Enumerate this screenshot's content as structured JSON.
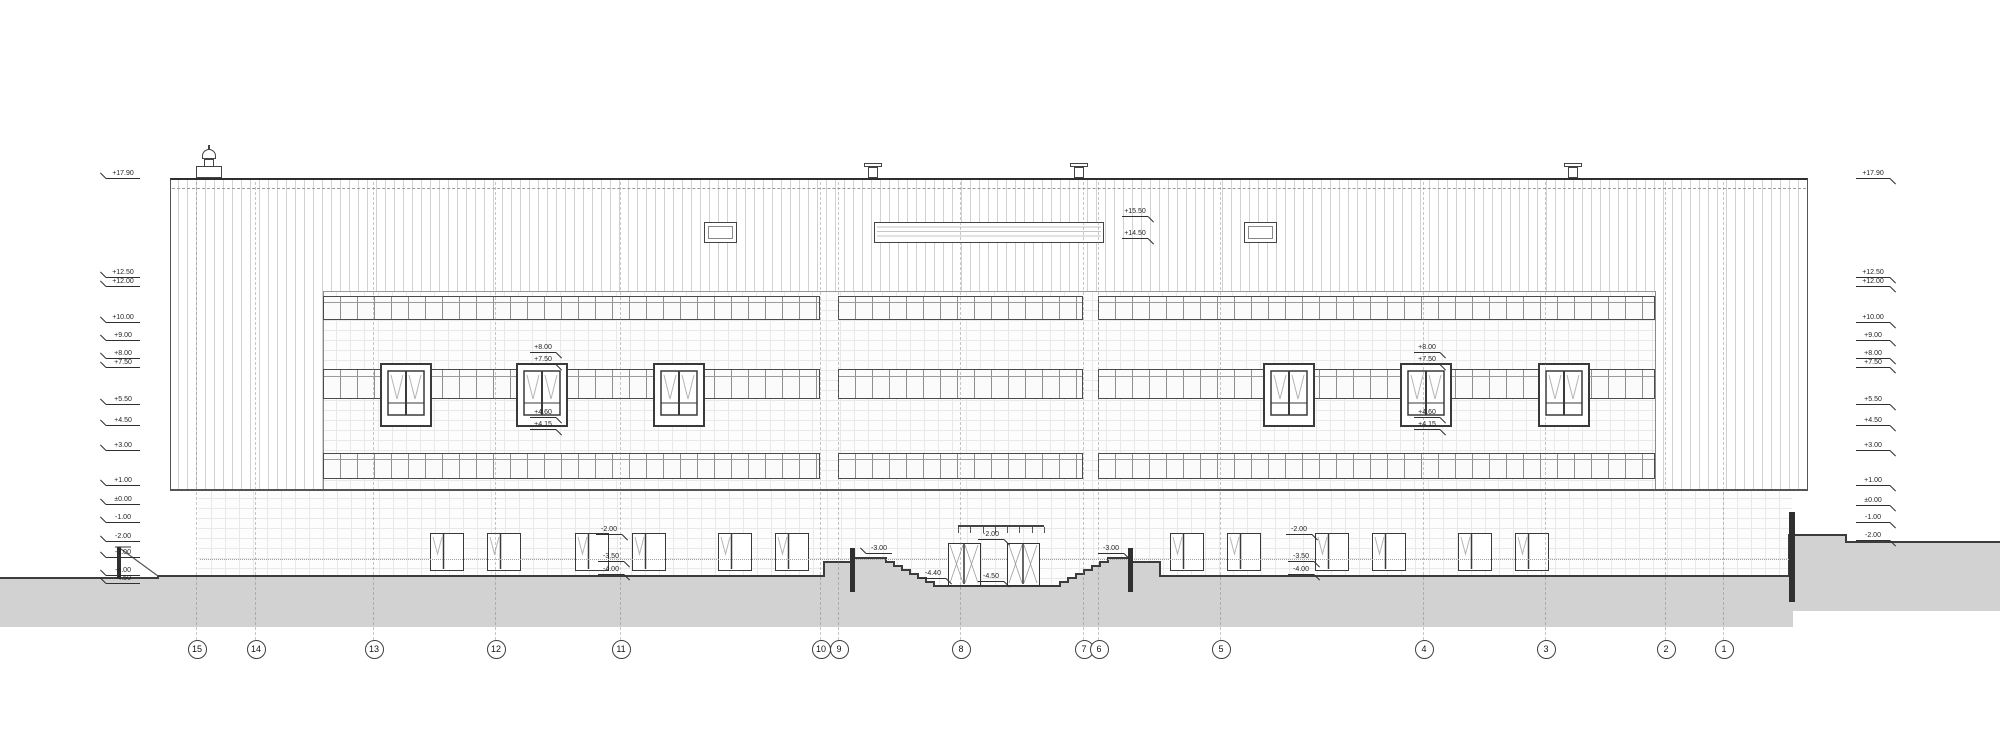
{
  "drawing": {
    "type": "architectural-elevation",
    "colors": {
      "line": "#2f2f2f",
      "mid": "#555555",
      "light": "#9a9a9a",
      "stripe": "#d2d2d2",
      "tile": "#e9e9e9",
      "ground": "#d2d2d2",
      "paper": "#ffffff"
    },
    "levels_left": [
      {
        "label": "+17.90",
        "y": 178
      },
      {
        "label": "+12.50",
        "y": 277
      },
      {
        "label": "+12.00",
        "y": 286
      },
      {
        "label": "+10.00",
        "y": 322
      },
      {
        "label": "+9.00",
        "y": 340
      },
      {
        "label": "+8.00",
        "y": 358
      },
      {
        "label": "+7.50",
        "y": 367
      },
      {
        "label": "+5.50",
        "y": 404
      },
      {
        "label": "+4.50",
        "y": 425
      },
      {
        "label": "+3.00",
        "y": 450
      },
      {
        "label": "+1.00",
        "y": 485
      },
      {
        "label": "±0.00",
        "y": 504
      },
      {
        "label": "-1.00",
        "y": 522
      },
      {
        "label": "-2.00",
        "y": 541
      },
      {
        "label": "-3.00",
        "y": 557
      },
      {
        "label": "-4.00",
        "y": 575
      },
      {
        "label": "-4.50",
        "y": 583
      }
    ],
    "levels_right": [
      {
        "label": "+17.90",
        "y": 178
      },
      {
        "label": "+12.50",
        "y": 277
      },
      {
        "label": "+12.00",
        "y": 286
      },
      {
        "label": "+10.00",
        "y": 322
      },
      {
        "label": "+9.00",
        "y": 340
      },
      {
        "label": "+8.00",
        "y": 358
      },
      {
        "label": "+7.50",
        "y": 367
      },
      {
        "label": "+5.50",
        "y": 404
      },
      {
        "label": "+4.50",
        "y": 425
      },
      {
        "label": "+3.00",
        "y": 450
      },
      {
        "label": "+1.00",
        "y": 485
      },
      {
        "label": "±0.00",
        "y": 505
      },
      {
        "label": "-1.00",
        "y": 522
      },
      {
        "label": "-2.00",
        "y": 540
      }
    ],
    "grid_axes": [
      {
        "label": "15",
        "x": 196
      },
      {
        "label": "14",
        "x": 255
      },
      {
        "label": "13",
        "x": 373
      },
      {
        "label": "12",
        "x": 495
      },
      {
        "label": "11",
        "x": 620
      },
      {
        "label": "10",
        "x": 820
      },
      {
        "label": "9",
        "x": 838
      },
      {
        "label": "8",
        "x": 960
      },
      {
        "label": "7",
        "x": 1083
      },
      {
        "label": "6",
        "x": 1098
      },
      {
        "label": "5",
        "x": 1220
      },
      {
        "label": "4",
        "x": 1423
      },
      {
        "label": "3",
        "x": 1545
      },
      {
        "label": "2",
        "x": 1665
      },
      {
        "label": "1",
        "x": 1723
      }
    ],
    "annotations": [
      {
        "label": "+15.50",
        "x": 1148,
        "y": 216,
        "side": "R"
      },
      {
        "label": "+14.50",
        "x": 1148,
        "y": 238,
        "side": "R"
      },
      {
        "label": "+8.00",
        "x": 556,
        "y": 352,
        "side": "R"
      },
      {
        "label": "+7.50",
        "x": 556,
        "y": 364,
        "side": "R"
      },
      {
        "label": "+4.60",
        "x": 556,
        "y": 417,
        "side": "R"
      },
      {
        "label": "+4.15",
        "x": 556,
        "y": 429,
        "side": "R"
      },
      {
        "label": "+8.00",
        "x": 1440,
        "y": 352,
        "side": "R"
      },
      {
        "label": "+7.50",
        "x": 1440,
        "y": 364,
        "side": "R"
      },
      {
        "label": "+4.60",
        "x": 1440,
        "y": 417,
        "side": "R"
      },
      {
        "label": "+4.15",
        "x": 1440,
        "y": 429,
        "side": "R"
      },
      {
        "label": "-2.00",
        "x": 622,
        "y": 534,
        "side": "R"
      },
      {
        "label": "-3.50",
        "x": 624,
        "y": 561,
        "side": "R"
      },
      {
        "label": "-4.00",
        "x": 624,
        "y": 574,
        "side": "R"
      },
      {
        "label": "-2.00",
        "x": 1312,
        "y": 534,
        "side": "R"
      },
      {
        "label": "-3.50",
        "x": 1314,
        "y": 561,
        "side": "R"
      },
      {
        "label": "-4.00",
        "x": 1314,
        "y": 574,
        "side": "R"
      },
      {
        "label": "-2.00",
        "x": 1004,
        "y": 539,
        "side": "R"
      },
      {
        "label": "-3.00",
        "x": 866,
        "y": 553,
        "side": "L"
      },
      {
        "label": "-3.00",
        "x": 1124,
        "y": 553,
        "side": "R"
      },
      {
        "label": "-4.40",
        "x": 946,
        "y": 578,
        "side": "R"
      },
      {
        "label": "-4.50",
        "x": 1004,
        "y": 581,
        "side": "R"
      }
    ],
    "geometry": {
      "upper_facade": {
        "x": 170,
        "y": 178,
        "w": 1638,
        "h": 312
      },
      "stripe_areas": [
        [
          170,
          178,
          153,
          312
        ],
        [
          1655,
          178,
          153,
          312
        ],
        [
          323,
          178,
          1332,
          113
        ]
      ],
      "tile_mid": {
        "x": 323,
        "y": 291,
        "w": 1332,
        "h": 199
      },
      "basement": {
        "x": 198,
        "y": 490,
        "w": 1594,
        "h": 98
      },
      "dashdot_y": 188,
      "band_rows": [
        {
          "y": 296,
          "h": 24,
          "t": 5
        },
        {
          "y": 369,
          "h": 30,
          "t": 6
        },
        {
          "y": 453,
          "h": 26,
          "t": 5
        }
      ],
      "band_segments": [
        [
          323,
          820
        ],
        [
          838,
          1083
        ],
        [
          1098,
          1655
        ]
      ],
      "dormers": {
        "xs": [
          380,
          516,
          653,
          1263,
          1400,
          1538
        ],
        "y": 363,
        "w": 52,
        "h": 64
      },
      "basement_windows": {
        "xs": [
          430,
          487,
          575,
          632,
          718,
          775,
          1170,
          1227,
          1315,
          1372,
          1458,
          1515
        ],
        "y": 533,
        "w": 34,
        "h": 38
      },
      "roof_windows": [
        [
          704,
          222,
          33,
          21
        ],
        [
          1244,
          222,
          33,
          21
        ]
      ],
      "roof_strip": {
        "x": 874,
        "y": 222,
        "w": 230,
        "h": 21
      },
      "chimney_x": 203,
      "vent_xs": [
        868,
        1074,
        1568
      ],
      "doors": {
        "xs": [
          948,
          1007
        ],
        "y": 543,
        "w": 33,
        "h": 43
      },
      "canopy": {
        "x": 958,
        "y": 525,
        "w": 86,
        "ticks": 7
      },
      "walls": [
        [
          850,
          548,
          5,
          44
        ],
        [
          1128,
          548,
          5,
          44
        ],
        [
          1789,
          512,
          6,
          90
        ],
        [
          117,
          547,
          4,
          31
        ]
      ],
      "misc_lines": [
        [
          121,
          549,
          158,
          576
        ],
        [
          115,
          547,
          131,
          547
        ]
      ],
      "dotted_line_y": 559,
      "bubble_y": 648,
      "grid_line_top": 182,
      "grid_line_bottom": 640,
      "terrain": {
        "profile_pre": [
          [
            0,
            578
          ],
          [
            158,
            578
          ],
          [
            158,
            576
          ],
          [
            824,
            576
          ],
          [
            824,
            562
          ],
          [
            851,
            562
          ],
          [
            851,
            558
          ],
          [
            878,
            558
          ]
        ],
        "stair_down": {
          "x": 878,
          "y": 558,
          "n": 7,
          "dx": 8,
          "dy": 4
        },
        "floor_to": 1060,
        "stair_up": {
          "n": 7,
          "dx": 8,
          "dy": 4
        },
        "profile_post": [
          [
            1131,
            558
          ],
          [
            1131,
            562
          ],
          [
            1160,
            562
          ],
          [
            1160,
            576
          ],
          [
            1789,
            576
          ],
          [
            1789,
            535
          ],
          [
            1846,
            535
          ],
          [
            1846,
            542
          ],
          [
            2000,
            542
          ]
        ],
        "bottom": [
          [
            2000,
            611
          ],
          [
            1793,
            611
          ],
          [
            1793,
            627
          ],
          [
            0,
            627
          ]
        ]
      }
    }
  }
}
